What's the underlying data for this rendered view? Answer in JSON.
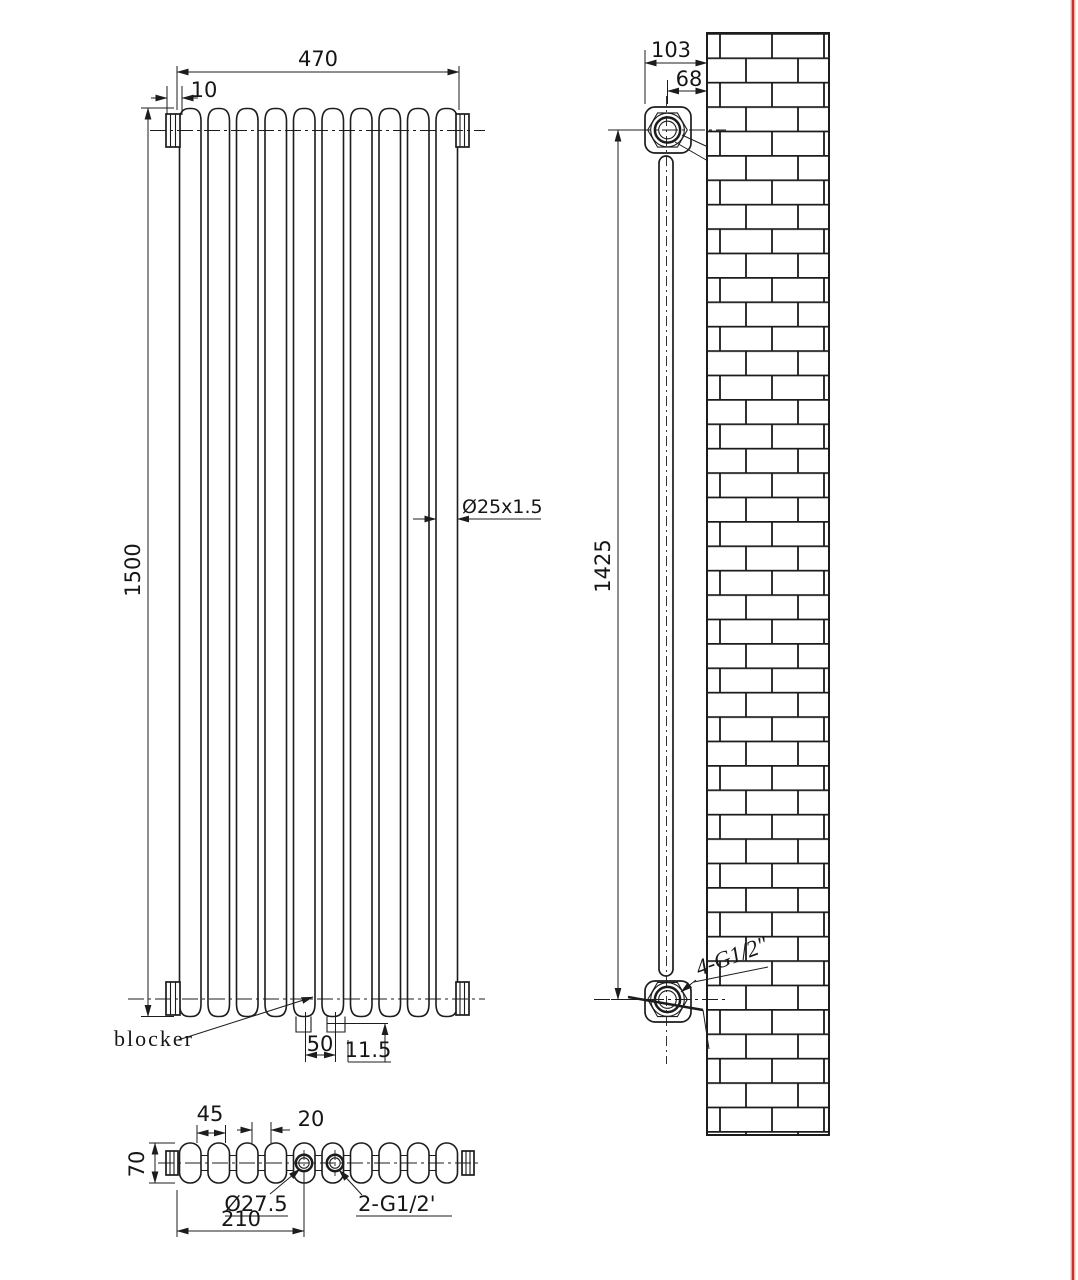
{
  "title": "Vertical column radiator technical drawing",
  "front_view": {
    "width": "470",
    "cap_dim": "10",
    "height": "1500",
    "tube_dim": "Ø25x1.5",
    "blocker_label": "blocker",
    "foot_spacing": "50",
    "foot_offset": "11.5"
  },
  "side_view": {
    "depth": "103",
    "wall_to_center": "68",
    "connection_height": "1425",
    "connections": "4-G1/2\""
  },
  "top_view": {
    "section_pitch": "45",
    "hole_offset": "20",
    "depth": "70",
    "hole_diameter": "Ø27.5",
    "hole_distance": "210",
    "connections": "2-G1/2'"
  },
  "colors": {
    "line": "#1c1c1c",
    "border_red": "#c63327"
  }
}
